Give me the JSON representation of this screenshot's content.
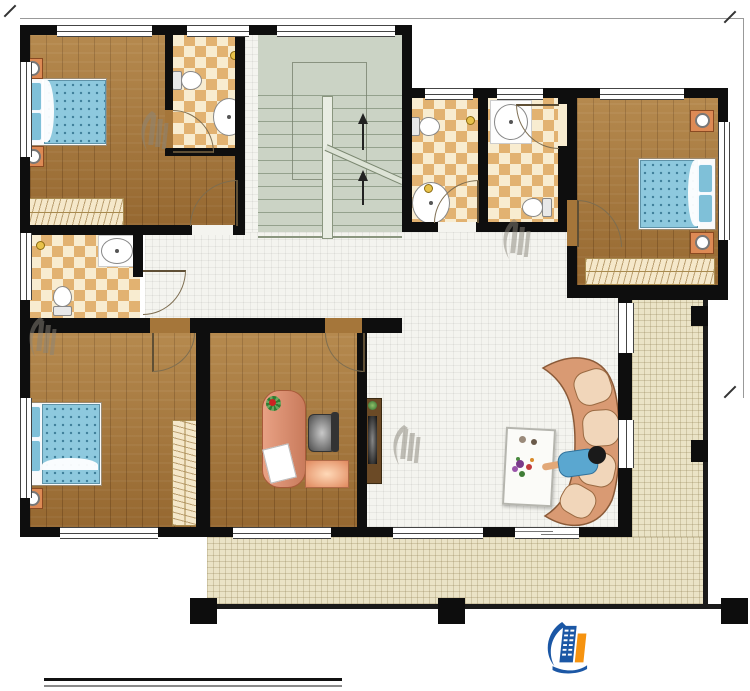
{
  "plan": {
    "dimensions": {
      "top": "13740",
      "right": "9840"
    },
    "stairs": {
      "down": "下",
      "up": "上"
    },
    "rooms": [
      {
        "id": "bedroom-top-left",
        "name": "卧室",
        "area": "11.75m²"
      },
      {
        "id": "bath-ensuite-top-left",
        "name": "内卫",
        "area": "2.98m²"
      },
      {
        "id": "bath-public",
        "name": "公卫",
        "area": "2.97m²"
      },
      {
        "id": "bath-ensuite-top-mid",
        "name": "内卫",
        "area": "3.26m²"
      },
      {
        "id": "bedroom-top-right",
        "name": "卧室",
        "area": "9.83m²"
      },
      {
        "id": "bath-ensuite-left",
        "name": "内卫",
        "area": "3.40m²"
      },
      {
        "id": "bedroom-bottom-left",
        "name": "卧室",
        "area": "12.63m²"
      },
      {
        "id": "study",
        "name": "书房",
        "area": "10.38m²"
      },
      {
        "id": "living-room",
        "name": "起居室",
        "area": "43.11m²"
      },
      {
        "id": "balcony",
        "name": "阳台",
        "area": "9.43m²"
      }
    ]
  },
  "title_block": {
    "plan_title": "二层平面图",
    "scale": "1:100",
    "floor_area_label": "本层建筑面积：",
    "floor_area_value": "132.52m²",
    "floor_height_label": "层高：",
    "floor_height_value": "3.3m"
  },
  "branding": {
    "company": "柏竣建筑",
    "website": "www.baijunjz.com",
    "logo_blue": "#1b57a5",
    "logo_orange": "#f6930f"
  },
  "watermark": {
    "company": "柏竣建筑",
    "website": "www.baijunjz.com"
  }
}
